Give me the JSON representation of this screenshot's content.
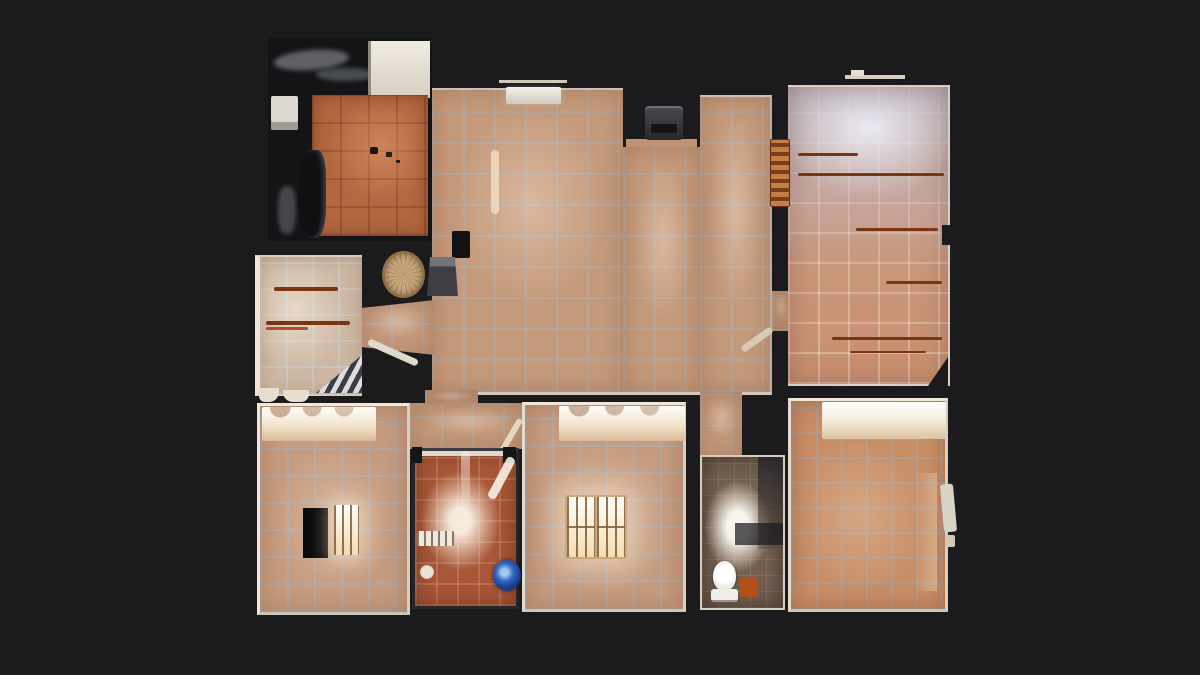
{
  "scene": {
    "view": "floorplan-top-down-3d-scan",
    "description": "Top-down dollhouse floor plan of a scanned apartment with terracotta tile floors on a dark background; no text or UI chrome visible"
  },
  "colors": {
    "background": "#1b1b1e",
    "wall_dark": "#141416",
    "wall_trim": "#e8decd",
    "hall_floor": "#c59a7c",
    "living_floor": "#b4683f",
    "right_room_bottom": "#c88f6f",
    "right_room_top": "#b4b4c4",
    "bedroom_floor": "#c69b7f",
    "bedroom_orange": "#c88e66",
    "storage_floor": "#a85637",
    "bath_floor": "#74604f",
    "entry_floor": "#cdb7a2",
    "window_glow": "#f9ecd0",
    "streak_brown": "#7a3511",
    "table_tan": "#c9a87e",
    "bucket_blue": "#3168c6",
    "mat_orange": "#b35018",
    "toilet_white": "#f0eee8",
    "stair_light": "#dcdce2",
    "stair_dark": "#3c3c42"
  },
  "rooms": [
    {
      "id": "living-room-top-left"
    },
    {
      "id": "main-hall"
    },
    {
      "id": "right-room"
    },
    {
      "id": "entry-hall"
    },
    {
      "id": "staircase"
    },
    {
      "id": "bedroom-bottom-left"
    },
    {
      "id": "storage-room"
    },
    {
      "id": "bedroom-bottom-middle"
    },
    {
      "id": "bathroom"
    },
    {
      "id": "bedroom-bottom-right"
    }
  ],
  "objects": [
    "stove",
    "window-sill",
    "round-table",
    "chair",
    "shutters",
    "stairs",
    "handrail",
    "door-leaf",
    "closet",
    "barred-window",
    "ladder",
    "toilet",
    "bath-mat",
    "shower-screen",
    "blue-bucket"
  ]
}
